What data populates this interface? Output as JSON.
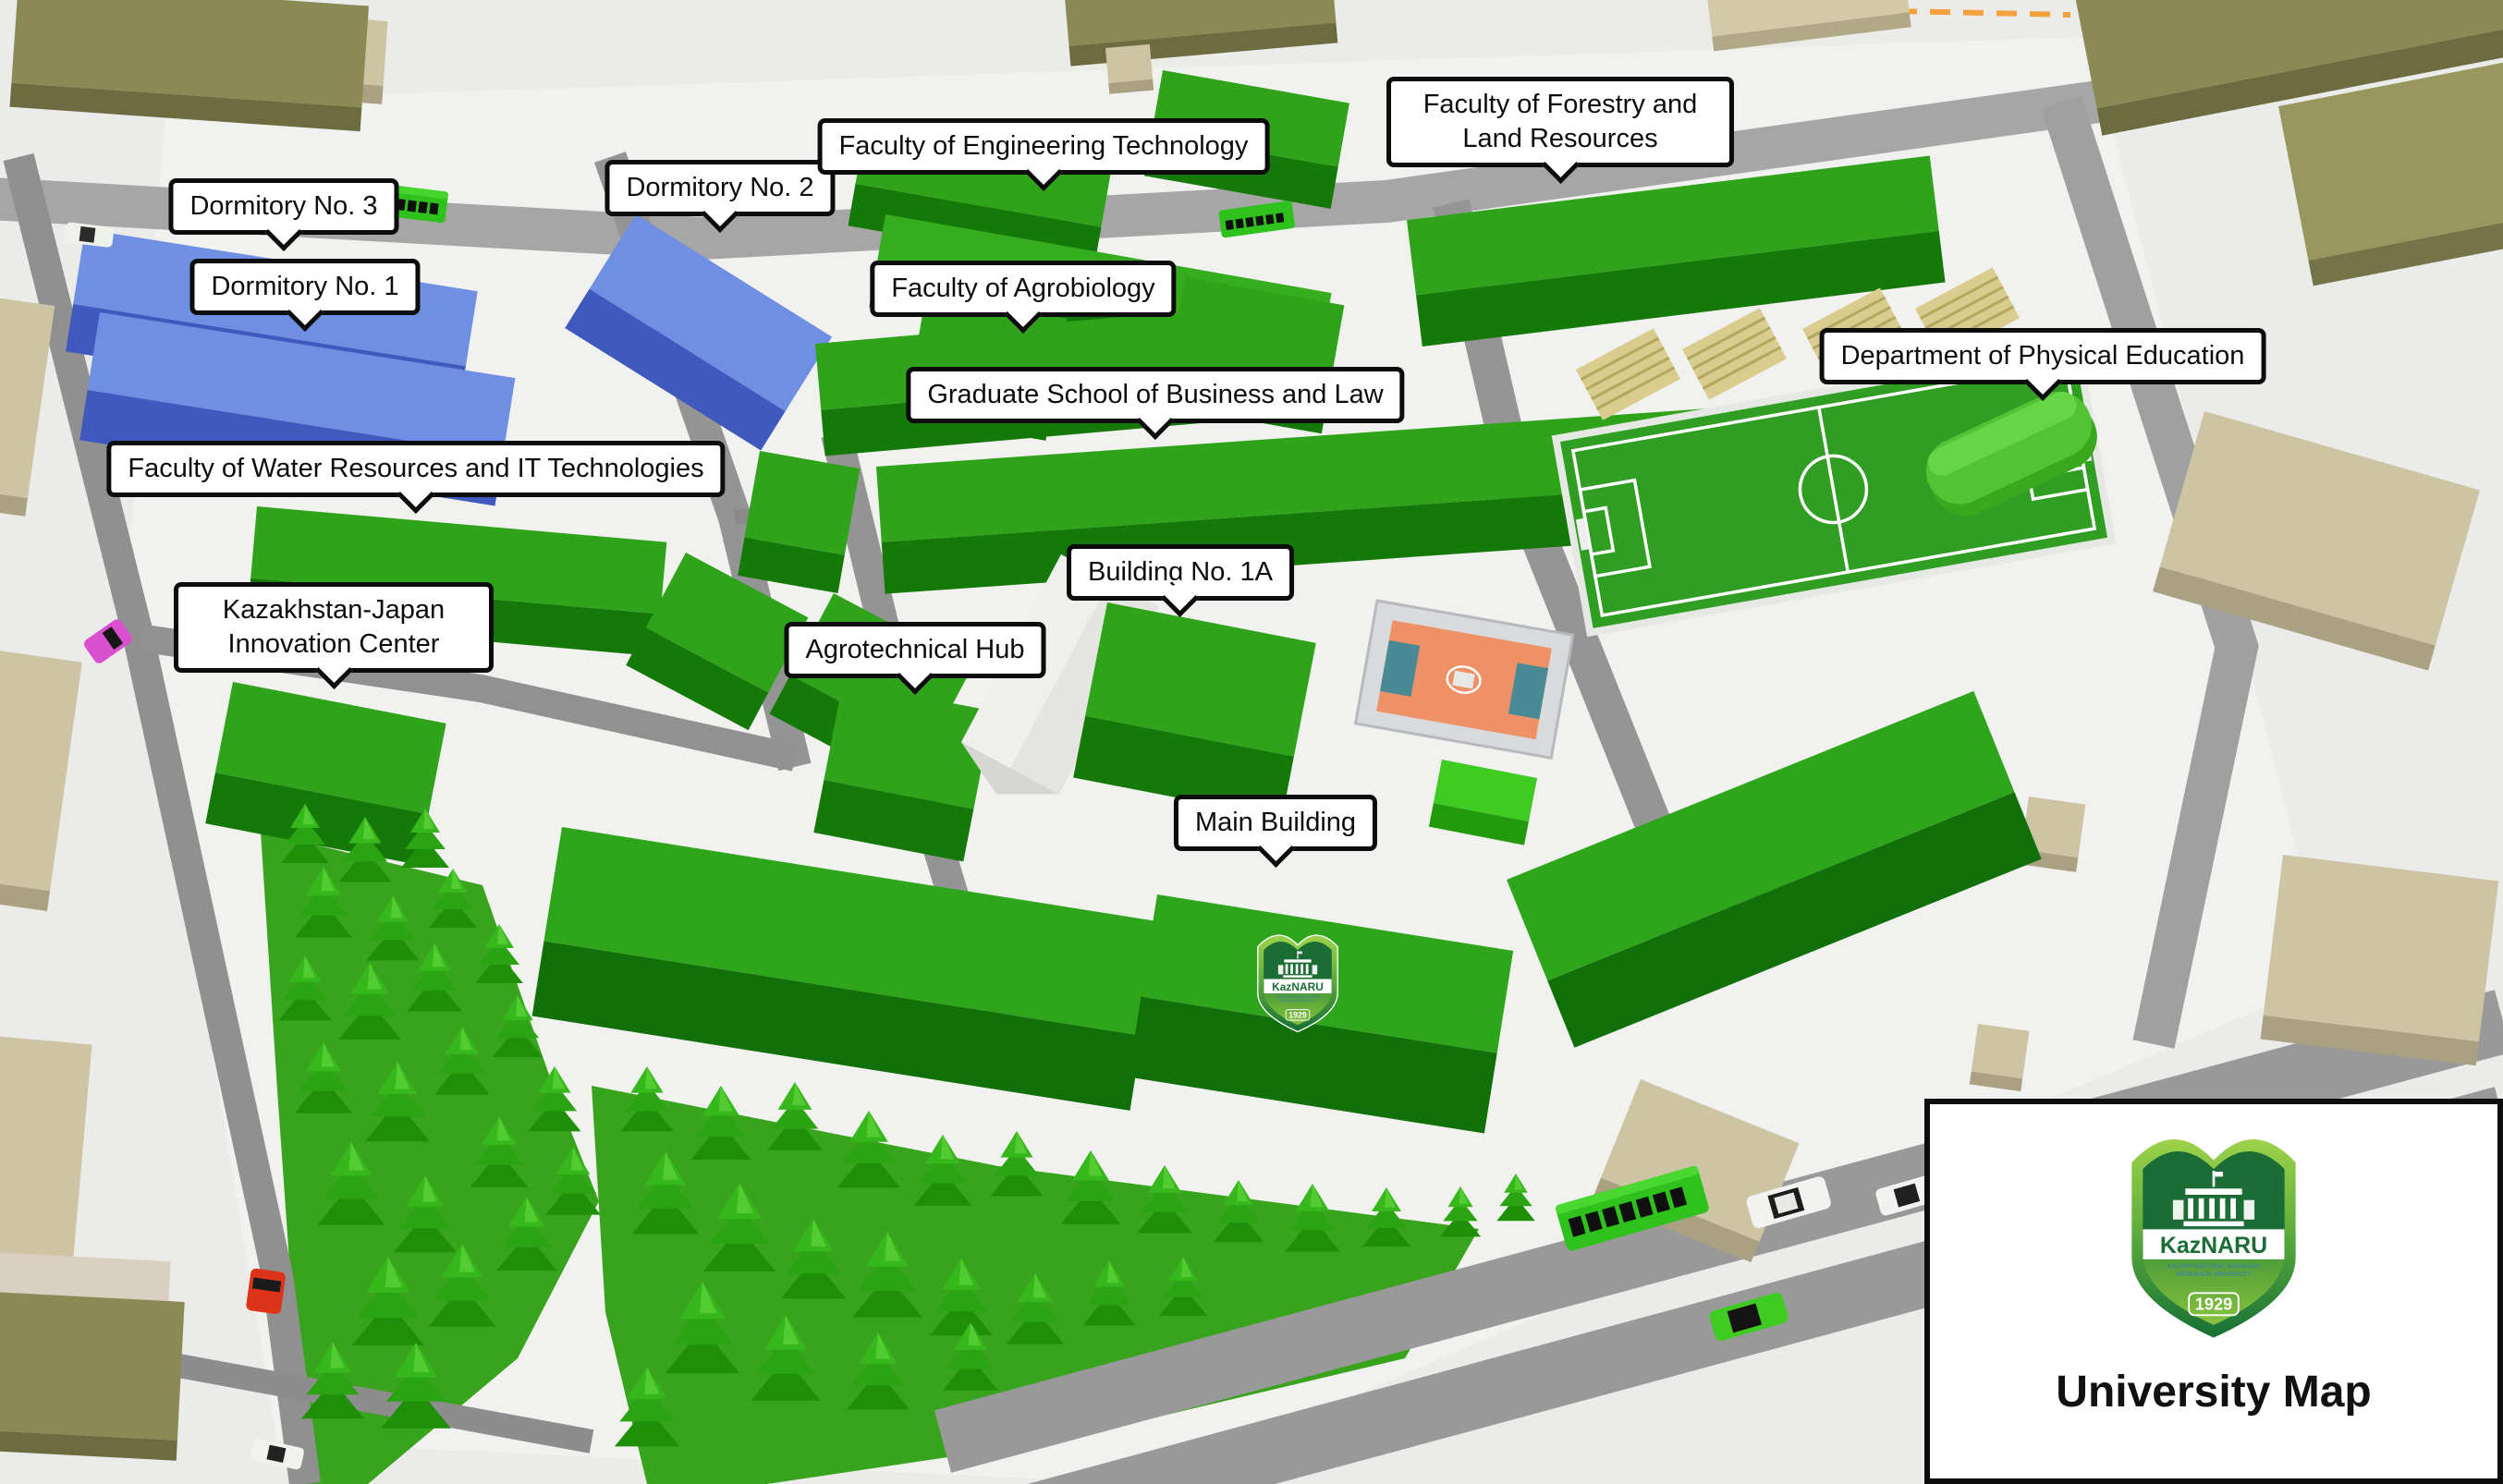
{
  "map": {
    "labels": [
      {
        "id": "dormitory-3",
        "text": "Dormitory No. 3"
      },
      {
        "id": "dormitory-1",
        "text": "Dormitory No. 1"
      },
      {
        "id": "dormitory-2",
        "text": "Dormitory No. 2"
      },
      {
        "id": "faculty-engineering",
        "text": "Faculty of Engineering Technology"
      },
      {
        "id": "faculty-forestry",
        "text": "Faculty of Forestry and Land Resources"
      },
      {
        "id": "faculty-agrobiology",
        "text": "Faculty of Agrobiology"
      },
      {
        "id": "graduate-school",
        "text": "Graduate School of Business and Law"
      },
      {
        "id": "dept-physical-education",
        "text": "Department of Physical Education"
      },
      {
        "id": "faculty-water-it",
        "text": "Faculty of Water Resources and IT Technologies"
      },
      {
        "id": "kazakh-japan-center",
        "text": "Kazakhstan-Japan Innovation Center"
      },
      {
        "id": "building-1a",
        "text": "Building No. 1A"
      },
      {
        "id": "agrotechnical-hub",
        "text": "Agrotechnical Hub"
      },
      {
        "id": "main-building",
        "text": "Main Building"
      }
    ]
  },
  "legend": {
    "title": "University Map",
    "logo": {
      "name": "KazNARU",
      "subtitle_line1": "KAZAKH NATIONAL AGRARIAN",
      "subtitle_line2": "RESEARCH UNIVERSITY",
      "year": "1929"
    }
  },
  "palette": {
    "ground": "#ebebe9",
    "road_gray": "#9c9c9c",
    "path_gray": "#8d8d8d",
    "campus_green_top": "#2fa31a",
    "campus_green_front": "#15790a",
    "dormitory_blue_top": "#6e8fe2",
    "dormitory_blue_front": "#4059be",
    "surrounding_olive": "#8b8a55",
    "surrounding_tan": "#cdc4a4",
    "forest_green": "#38a41d",
    "field_green": "#2f9e23",
    "court_orange": "#ef9166",
    "court_teal": "#4a8a94",
    "physed_green": "#52c434",
    "bleacher_tan": "#d9cc8e",
    "label_bg": "#ffffff",
    "label_border": "#0c0c0c",
    "label_text": "#0c0c0c",
    "logo_light_green": "#8dc63f",
    "logo_dark_green": "#1b6d35",
    "bus_green": "#2fc11c",
    "car_red": "#dd3318",
    "car_pink": "#d94fd0",
    "car_white": "#f2f2f0",
    "road_marking_orange": "#f2a13c"
  }
}
